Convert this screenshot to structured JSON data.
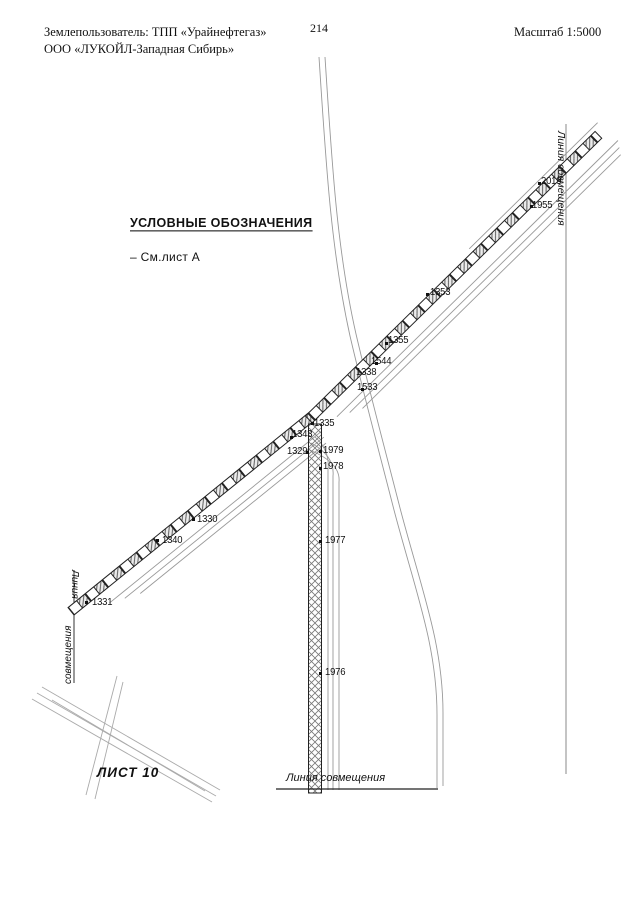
{
  "header": {
    "landowner_line1": "Землепользователь: ТПП «Урайнефтегаз»",
    "landowner_line2": "ООО «ЛУКОЙЛ-Западная Сибирь»",
    "page_number": "214",
    "scale_label": "Масштаб 1:5000"
  },
  "legend": {
    "title": "УСЛОВНЫЕ ОБОЗНАЧЕНИЯ",
    "note": "– См.лист А"
  },
  "map": {
    "sheet_label": "ЛИСТ 10",
    "match_line_bottom": "Линия совмещения",
    "match_line_right": "Линия совмещения",
    "match_line_left_word1": "Линия",
    "match_line_left_word2": "совмещения",
    "points": [
      {
        "label": "1331"
      },
      {
        "label": "1340"
      },
      {
        "label": "1330"
      },
      {
        "label": "1329"
      },
      {
        "label": "1343"
      },
      {
        "label": "1335"
      },
      {
        "label": "1533"
      },
      {
        "label": "1338"
      },
      {
        "label": "1544"
      },
      {
        "label": "1355"
      },
      {
        "label": "1353"
      },
      {
        "label": "1955"
      },
      {
        "label": "2019"
      },
      {
        "label": "1979"
      },
      {
        "label": "1978"
      },
      {
        "label": "1977"
      },
      {
        "label": "1976"
      }
    ]
  },
  "colors": {
    "paper": "#ffffff",
    "line_dark": "#1a1a1a",
    "line_gray": "#999999"
  }
}
